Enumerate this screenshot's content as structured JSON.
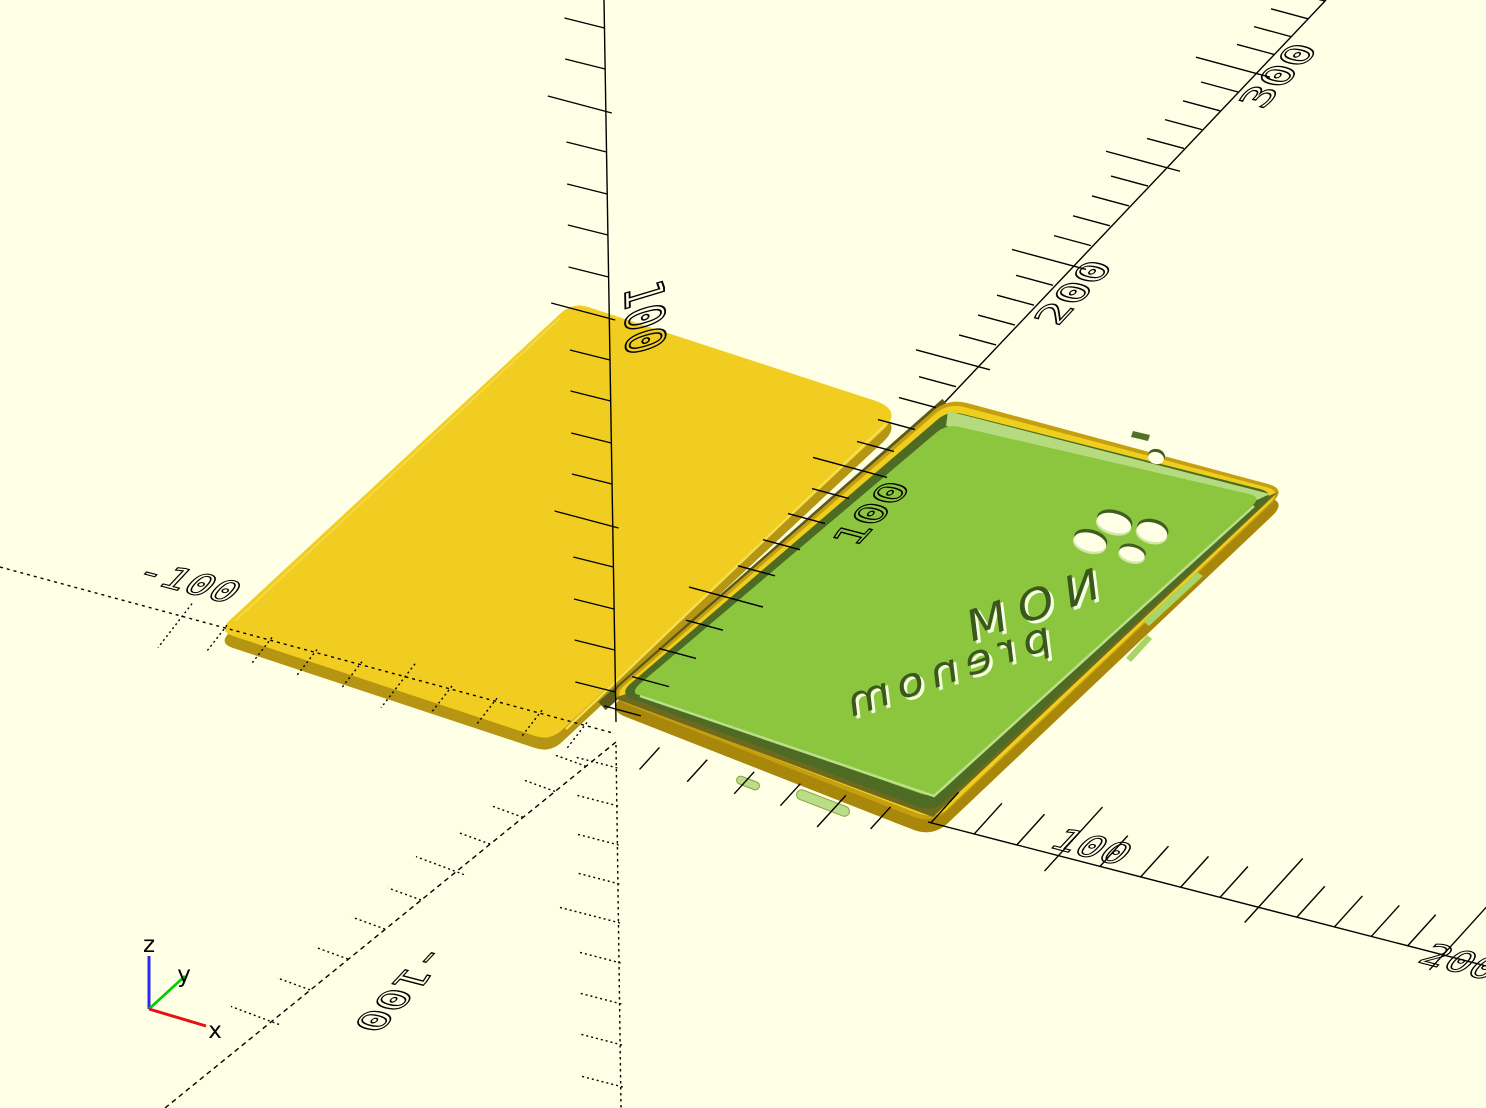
{
  "viewport": {
    "background": "#FFFFE5",
    "width": 1486,
    "height": 1108
  },
  "axes": {
    "line_color": "#000000",
    "x_axis": {
      "labels": {
        "neg_100": "-100",
        "pos_100": "100",
        "pos_200": "200"
      }
    },
    "y_axis": {
      "labels": {
        "neg_100": "-100",
        "pos_100": "100",
        "pos_200": "200",
        "pos_300": "300"
      }
    },
    "z_axis": {
      "labels": {
        "pos_100": "100"
      }
    }
  },
  "axis_indicator": {
    "x": {
      "label": "x",
      "color": "#E81010"
    },
    "y": {
      "label": "y",
      "color": "#00CC00"
    },
    "z": {
      "label": "z",
      "color": "#2A2AEE"
    }
  },
  "model": {
    "back_plate": {
      "top_color": "#F0CD20",
      "side_color": "#B59512",
      "edge_highlight_color": "#F6DE50"
    },
    "phone_case": {
      "outer_color": "#C69F11",
      "rim_color": "#EFCE1E",
      "wall_dark_color": "#4E6B24",
      "wall_light_color": "#B5DB7E",
      "floor_color": "#8CC63F",
      "camera_hole_count": 4,
      "flash_hole_count": 1,
      "engraving": {
        "line1": "NOM",
        "line2": "prenom",
        "mirrored": true,
        "color": "#3A571C",
        "highlight_color": "#F6FFE2"
      }
    }
  }
}
